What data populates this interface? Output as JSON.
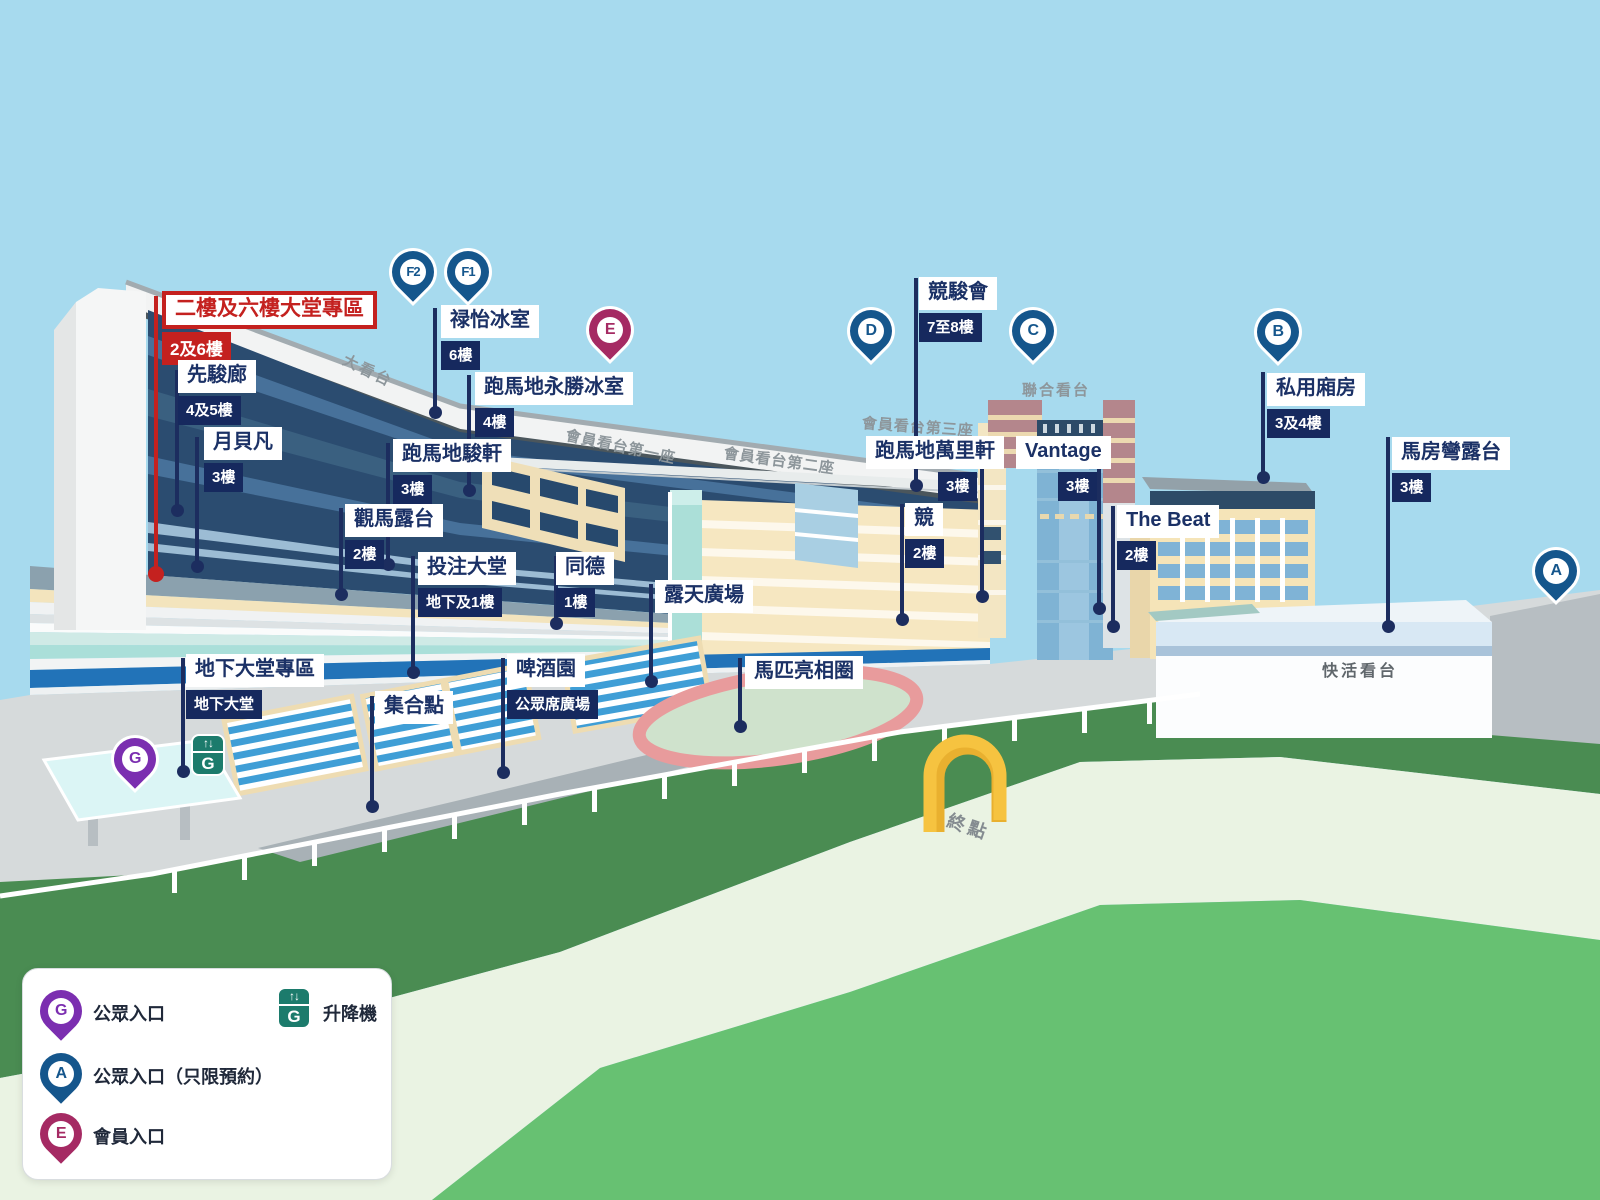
{
  "colors": {
    "sky": "#a7daee",
    "accent_red": "#c4211f",
    "label_navy": "#16295e",
    "pin_blue": "#15568c",
    "pin_purple": "#7b2eb0",
    "pin_crimson": "#a52a63",
    "lift_green": "#1c7b6c",
    "track_dark_green": "#4a8c52",
    "track_light_green": "#67c172"
  },
  "red_zone": {
    "title": "二樓及六樓大堂專區",
    "floor": "2及6樓"
  },
  "annotations": [
    {
      "title": "先駿廊",
      "floor": "4及5樓"
    },
    {
      "title": "月貝凡",
      "floor": "3樓"
    },
    {
      "title": "禄怡冰室",
      "floor": "6樓"
    },
    {
      "title": "跑馬地永勝冰室",
      "floor": "4樓"
    },
    {
      "title": "跑馬地駿軒",
      "floor": "3樓"
    },
    {
      "title": "觀馬露台",
      "floor": "2樓"
    },
    {
      "title": "投注大堂",
      "floor": "地下及1樓"
    },
    {
      "title": "同德",
      "floor": "1樓"
    },
    {
      "title": "露天廣場"
    },
    {
      "title": "啤酒園",
      "floor": "公眾席廣場"
    },
    {
      "title": "集合點"
    },
    {
      "title": "地下大堂專區",
      "floor": "地下大堂"
    },
    {
      "title": "馬匹亮相圈"
    },
    {
      "title": "競駿會",
      "floor": "7至8樓"
    },
    {
      "title": "跑馬地萬里軒",
      "floor": "3樓"
    },
    {
      "title": "競",
      "floor": "2樓"
    },
    {
      "title": "Vantage",
      "floor": "3樓"
    },
    {
      "title": "The Beat",
      "floor": "2樓"
    },
    {
      "title": "私用廂房",
      "floor": "3及4樓"
    },
    {
      "title": "馬房彎露台",
      "floor": "3樓"
    }
  ],
  "pins": {
    "f2": "F2",
    "f1": "F1",
    "e": "E",
    "d": "D",
    "c": "C",
    "b": "B",
    "a": "A",
    "g": "G"
  },
  "scene_labels": {
    "grandstand": "大看台",
    "member_stand_1": "會員看台第一座",
    "member_stand_2": "會員看台第二座",
    "member_stand_3": "會員看台第三座",
    "union_stand": "聯合看台",
    "happy_stand": "快活看台",
    "finish": "終點"
  },
  "lift": {
    "arrows": "↑↓",
    "letter": "G"
  },
  "legend": {
    "items": [
      {
        "pin": "G",
        "label": "公眾入口"
      },
      {
        "pin": "A",
        "label": "公眾入口（只限預約）"
      },
      {
        "pin": "E",
        "label": "會員入口"
      }
    ],
    "lift_label": "升降機"
  }
}
